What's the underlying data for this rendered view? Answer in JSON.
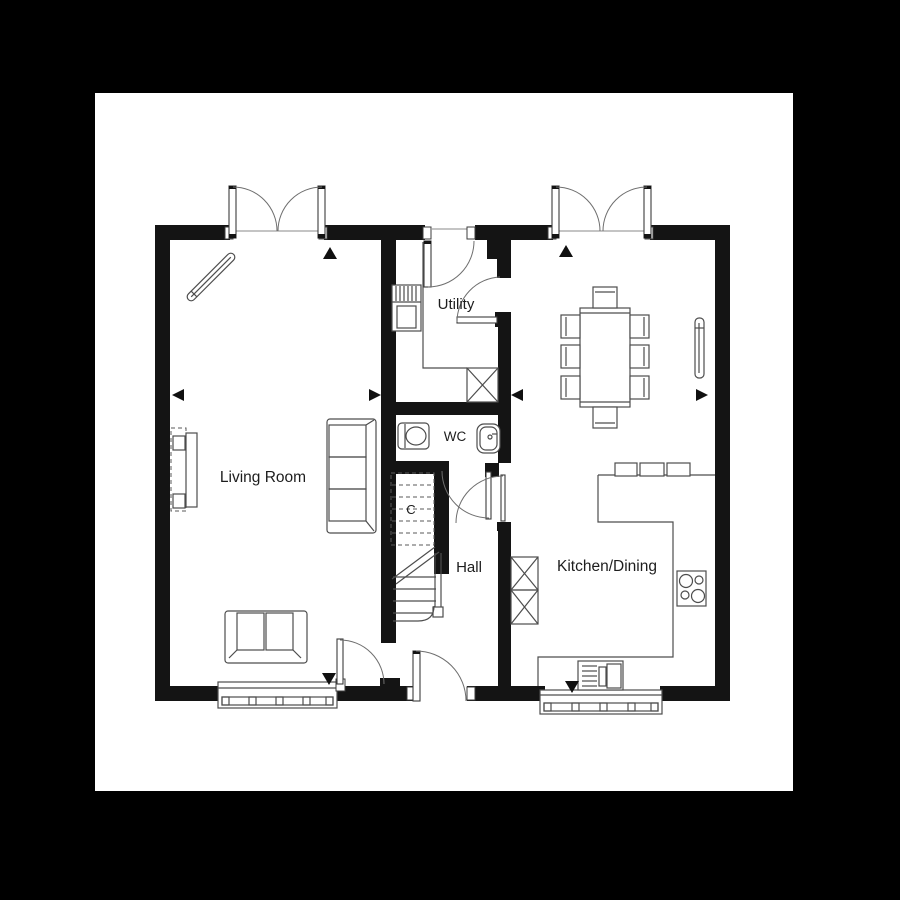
{
  "canvas": {
    "background_color": "#000000",
    "sheet_color": "#ffffff",
    "wall_color": "#141414",
    "line_color": "#4d4d4d",
    "text_color": "#1d1d1d"
  },
  "plan": {
    "type": "ground-floor-plan",
    "rooms": {
      "living_room": {
        "label": "Living Room"
      },
      "utility": {
        "label": "Utility"
      },
      "wc": {
        "label": "WC"
      },
      "cupboard": {
        "label": "C"
      },
      "hall": {
        "label": "Hall"
      },
      "kitchen_dining": {
        "label": "Kitchen/Dining"
      }
    },
    "symbols": [
      "french-doors-living-room",
      "french-doors-kitchen",
      "utility-back-door",
      "utility-inner-door",
      "wc-door",
      "kitchen-door",
      "living-room-door",
      "front-door",
      "window-living-room",
      "window-kitchen",
      "stairs",
      "stair-break-line",
      "sofa-3-seat",
      "sofa-2-seat",
      "media-unit",
      "radiator-diagonal",
      "radiator-vertical",
      "washing-machine",
      "appliance-space-x",
      "tall-units-x",
      "worktop",
      "wall-cabinets",
      "hob",
      "sink-drainer",
      "dining-table",
      "dining-chairs",
      "toilet",
      "basin",
      "marker-triangles"
    ],
    "marker_triangle_count": 8
  }
}
